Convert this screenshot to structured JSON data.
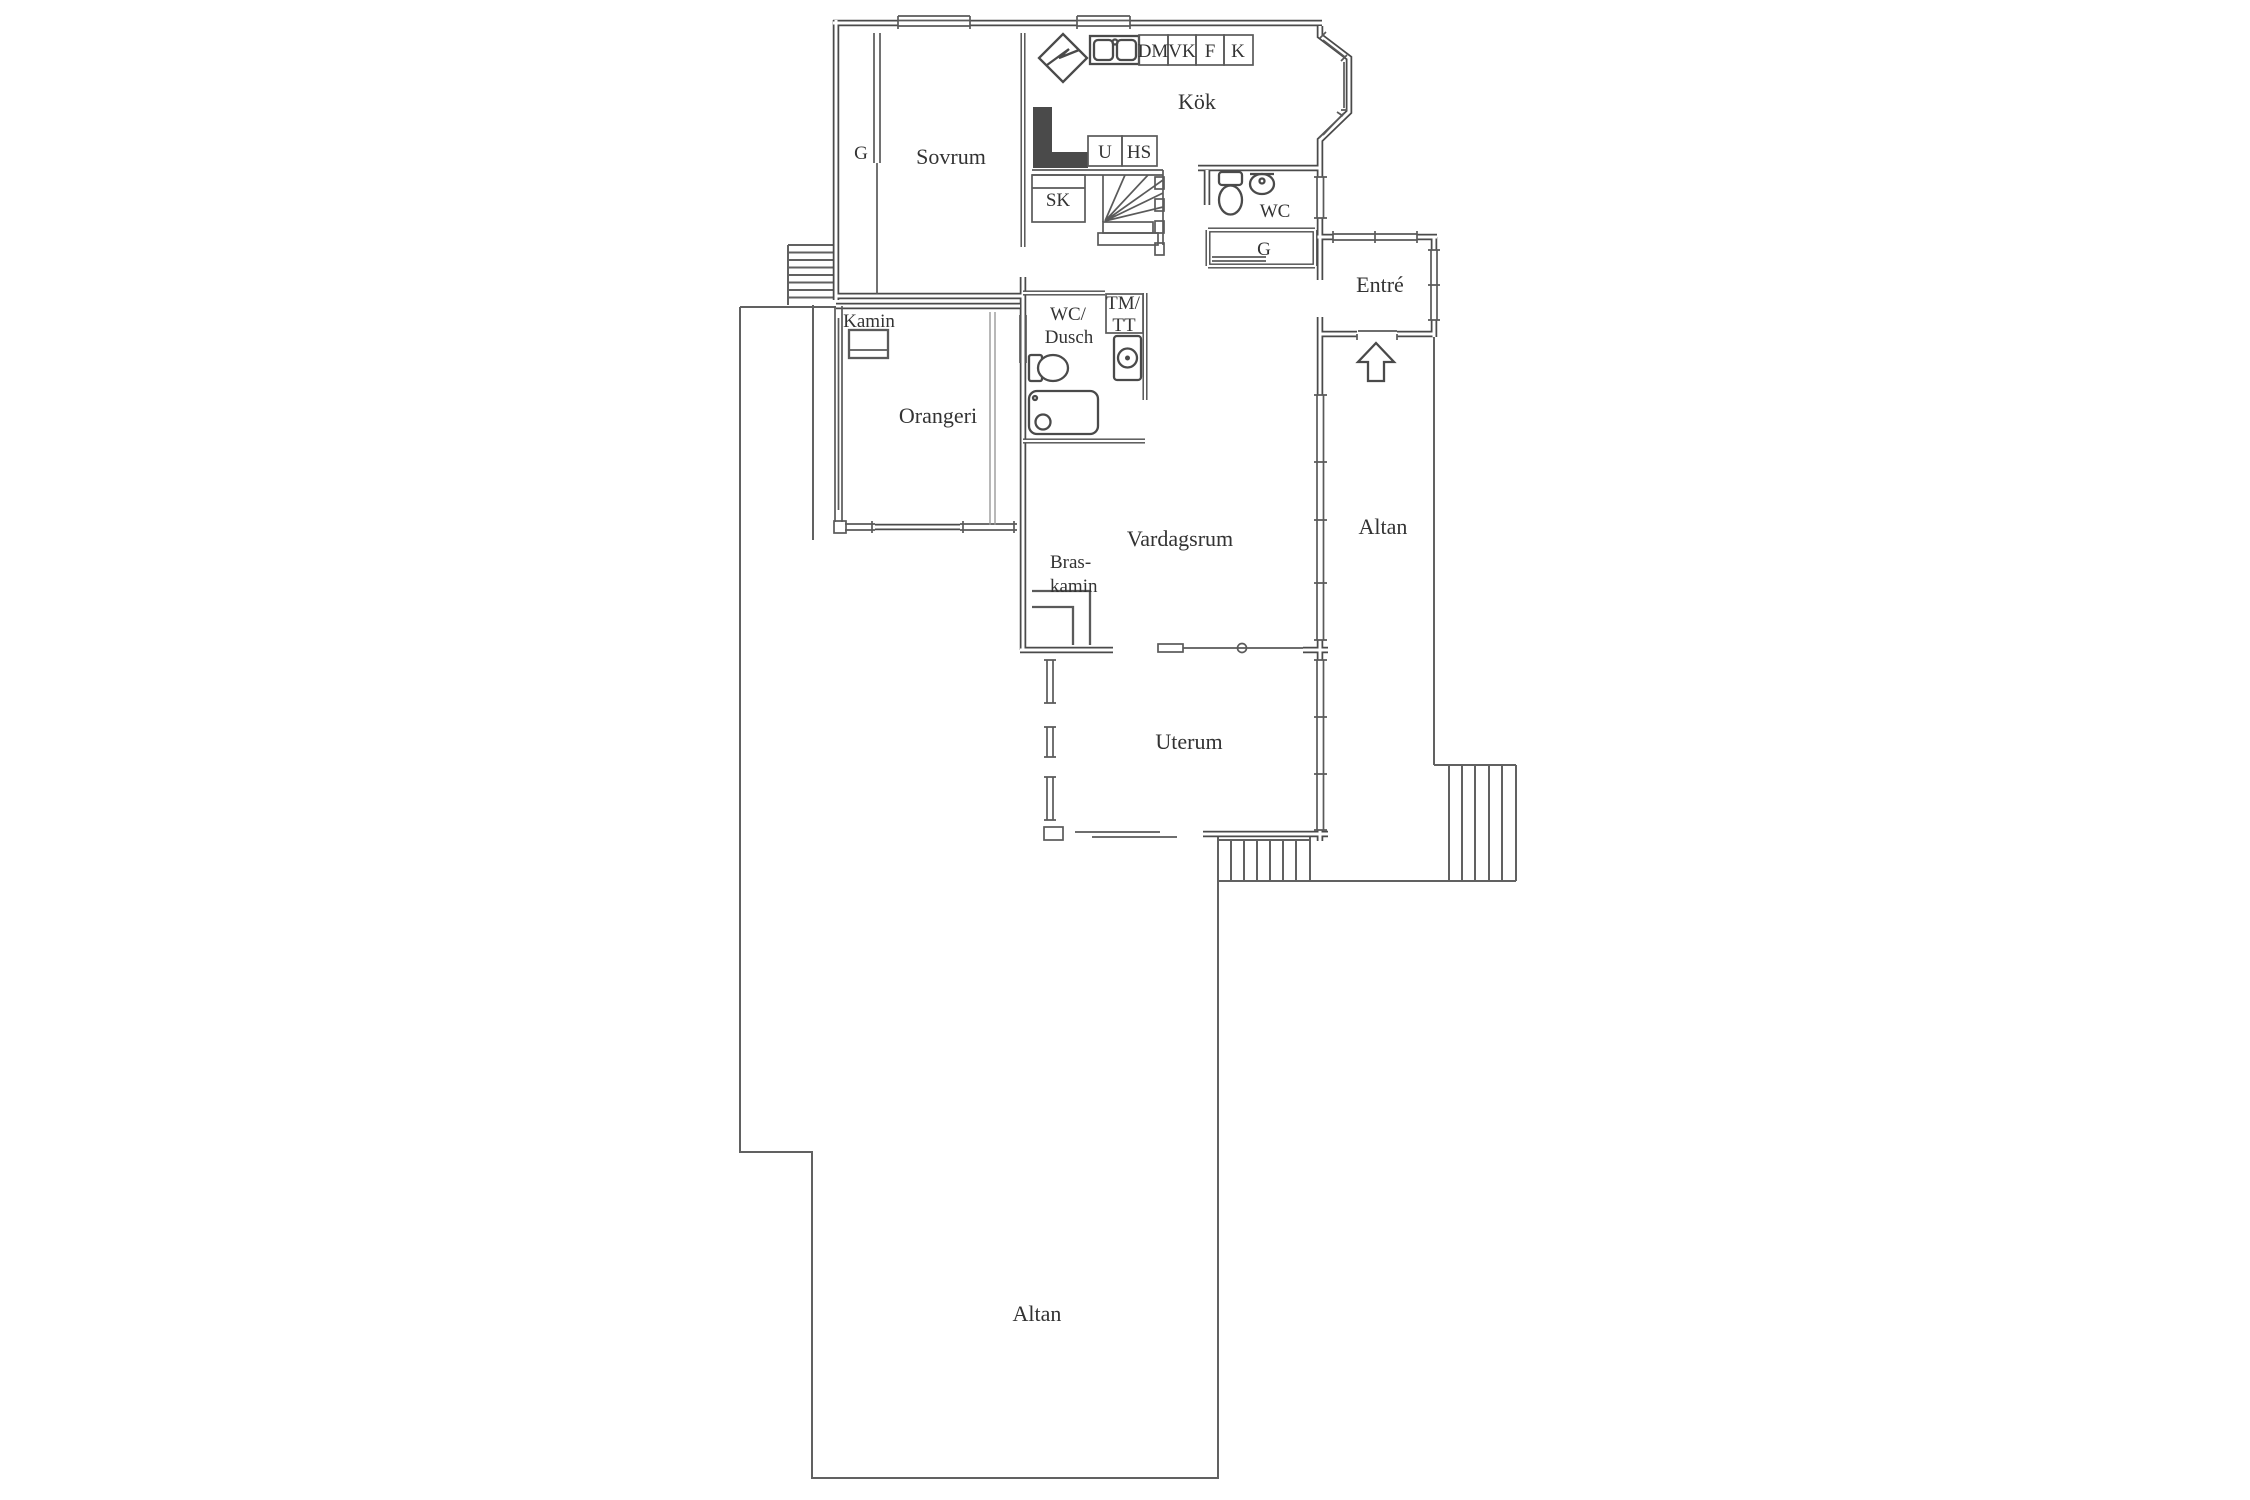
{
  "drawing": {
    "kind": "residential floor plan",
    "language": "Swedish"
  },
  "labels": {
    "kok": "Kök",
    "sovrum": "Sovrum",
    "g_sovrum": "G",
    "dm": "DM",
    "vk": "VK",
    "f": "F",
    "k": "K",
    "u": "U",
    "hs": "HS",
    "sk": "SK",
    "wc": "WC",
    "g_hall": "G",
    "entre": "Entré",
    "kamin": "Kamin",
    "orangeri": "Orangeri",
    "wc_dusch_1": "WC/",
    "wc_dusch_2": "Dusch",
    "tm_tt_1": "TM/",
    "tm_tt_2": "TT",
    "vardagsrum": "Vardagsrum",
    "braskamin_1": "Bras-",
    "braskamin_2": "kamin",
    "altan_upper": "Altan",
    "uterum": "Uterum",
    "altan_lower": "Altan"
  },
  "colors": {
    "wall": "#4a4a4a",
    "thin": "#5a5a5a",
    "deck": "#616161",
    "faint": "#9a9a9a",
    "text": "#333333",
    "bg": "#ffffff"
  }
}
